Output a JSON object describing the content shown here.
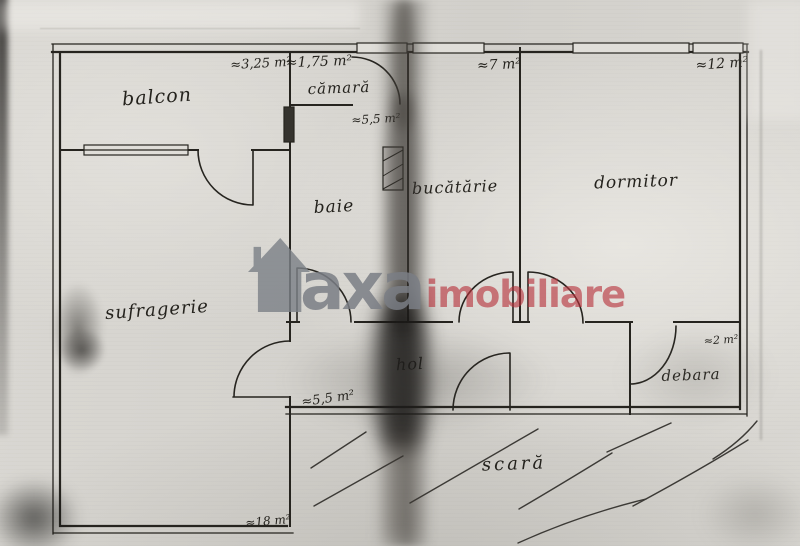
{
  "watermark": {
    "brand_first": "axa",
    "brand_second": "imobiliare",
    "grey_color": "#7a7e85",
    "red_color": "#b7303a",
    "icon": "house-icon"
  },
  "rooms": {
    "balcon": {
      "name": "balcon",
      "area": "≈3,25 m²"
    },
    "camara": {
      "name": "cămară",
      "area": "≈1,75 m²"
    },
    "baie": {
      "name": "baie",
      "area": "≈5,5 m²"
    },
    "bucatarie": {
      "name": "bucătărie",
      "area": "≈7 m²"
    },
    "dormitor": {
      "name": "dormitor",
      "area": "≈12 m²"
    },
    "sufragerie": {
      "name": "sufragerie",
      "area": "≈18 m²"
    },
    "hol": {
      "name": "hol",
      "area": "≈5,5 m²"
    },
    "debara": {
      "name": "debara",
      "area": "≈2 m²"
    },
    "scara": {
      "name": "scară"
    }
  },
  "colors": {
    "ink": "#26241f",
    "paper": "#d8d6d1"
  }
}
